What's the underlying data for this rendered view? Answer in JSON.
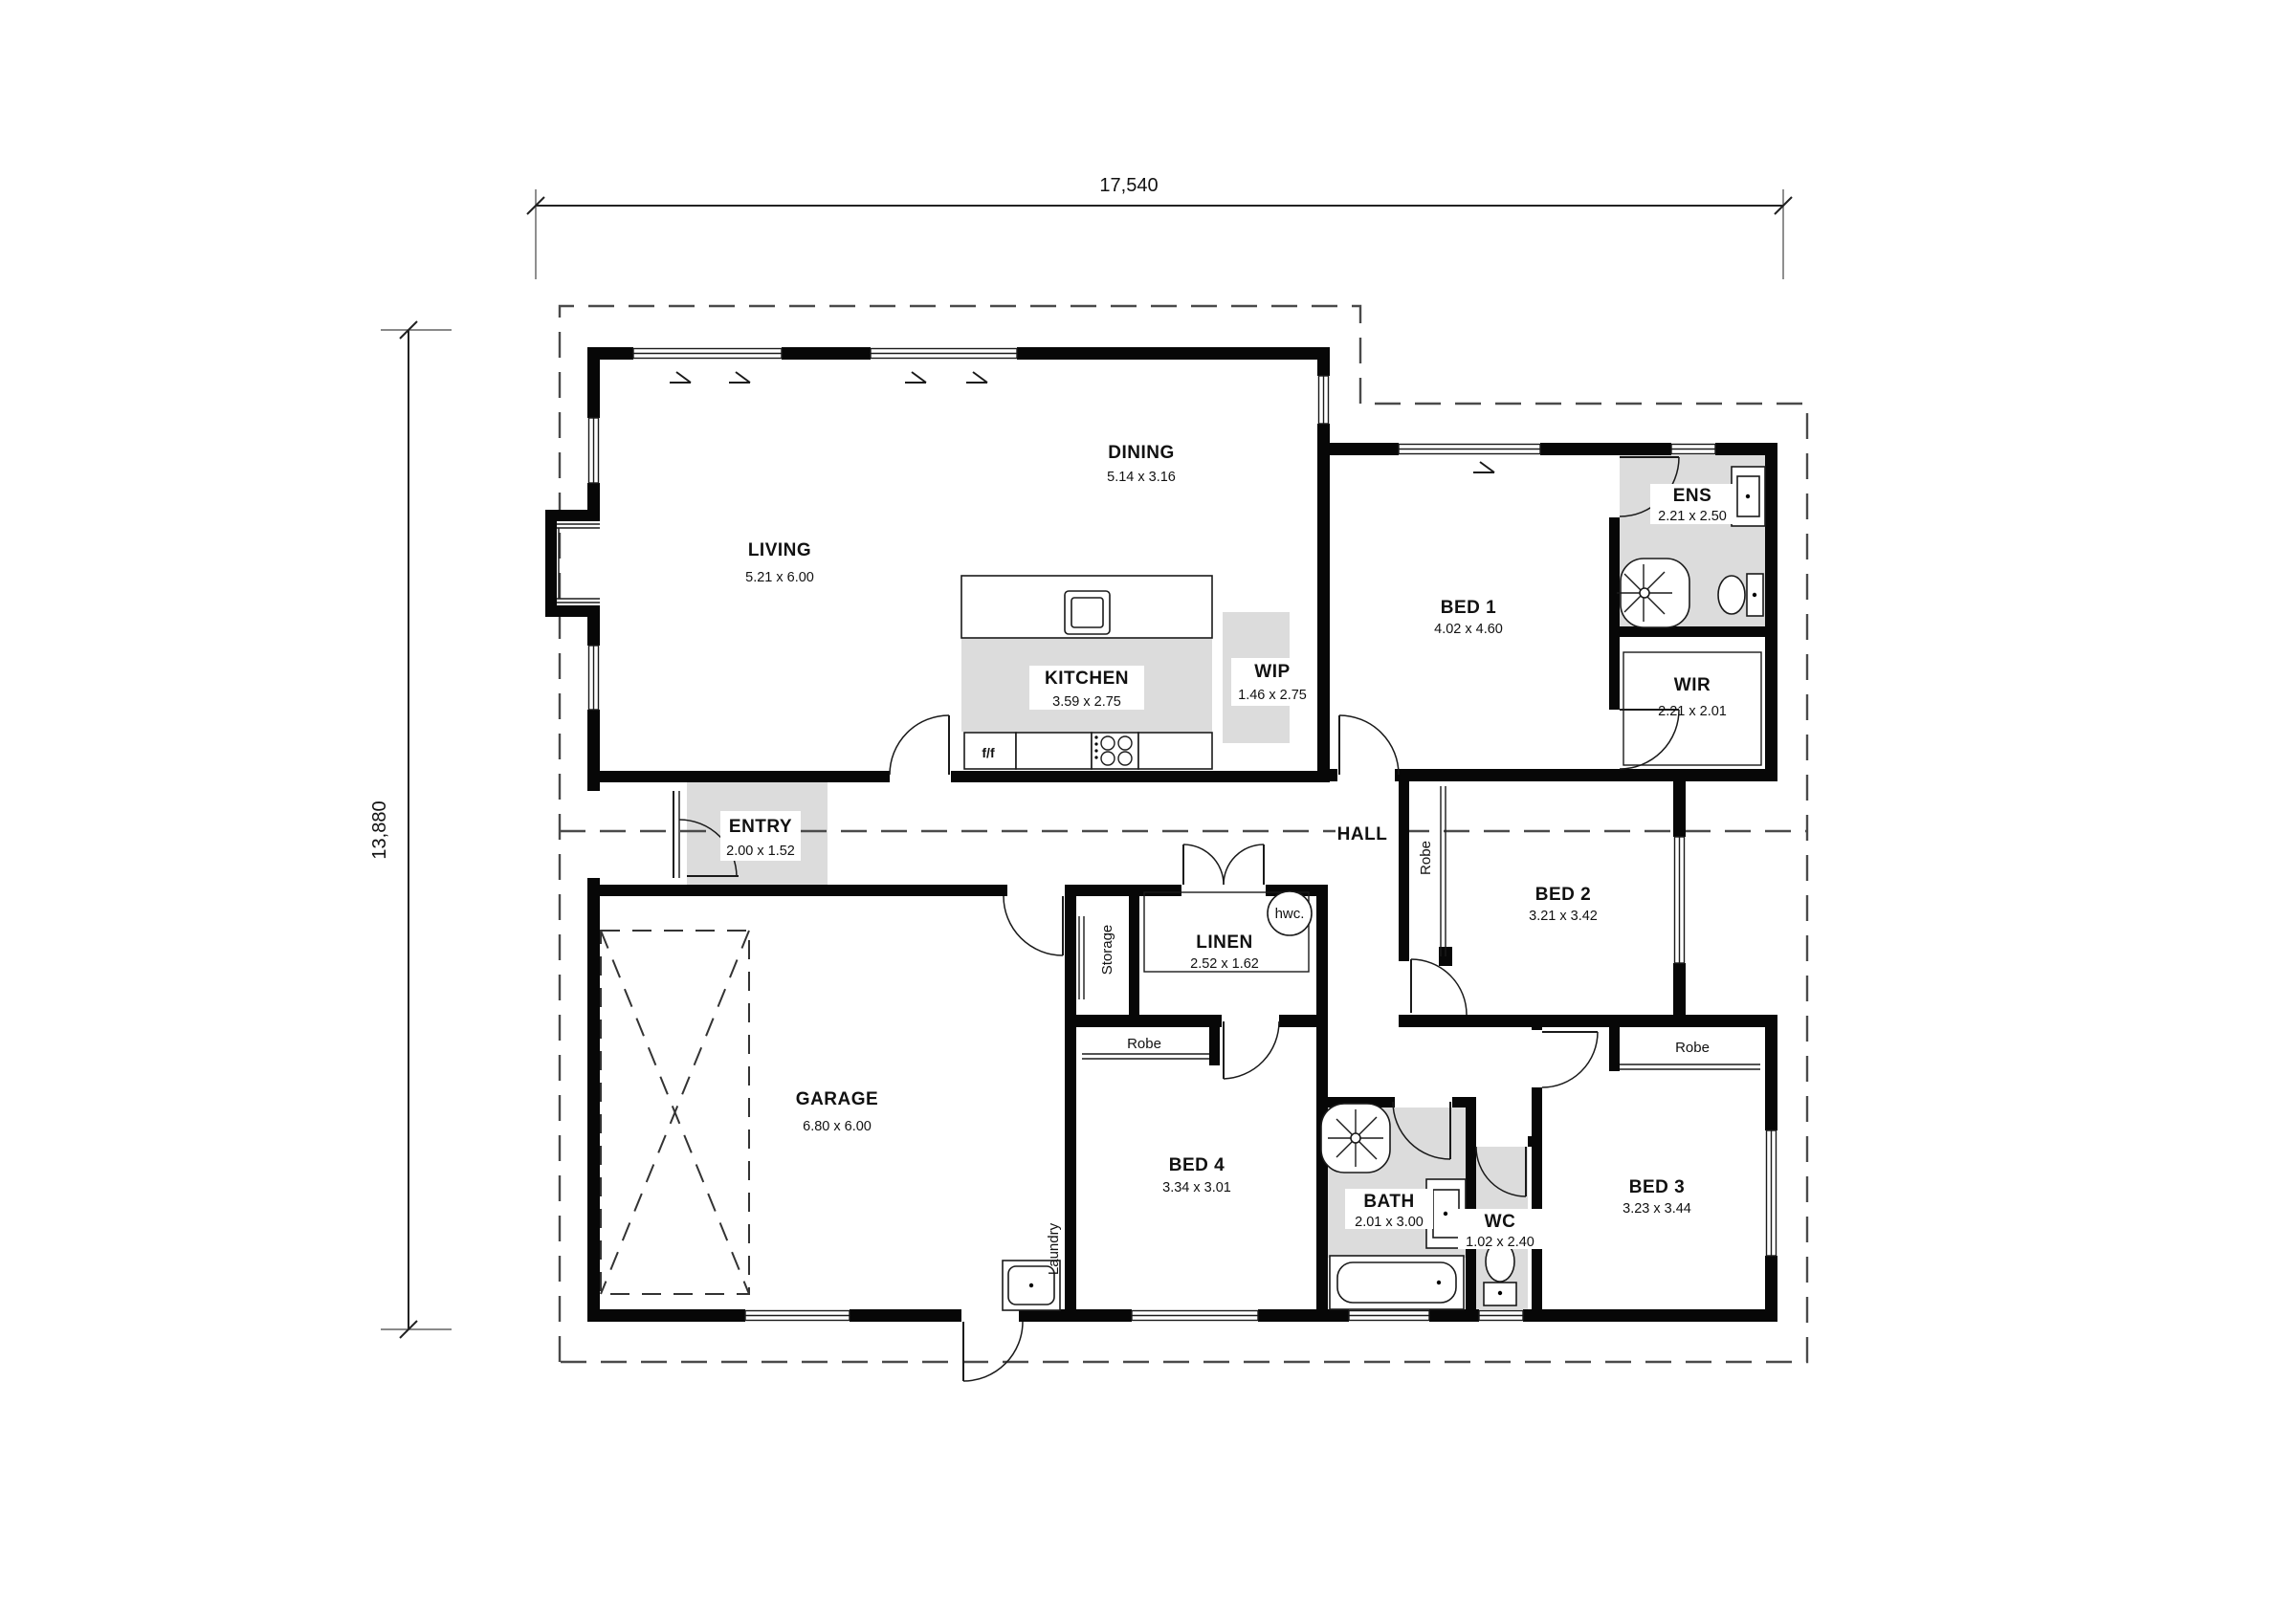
{
  "plan": {
    "dimensions": {
      "overall_width": "17,540",
      "overall_height": "13,880"
    },
    "rooms": {
      "living": {
        "name": "LIVING",
        "dims": "5.21 x 6.00"
      },
      "dining": {
        "name": "DINING",
        "dims": "5.14 x 3.16"
      },
      "kitchen": {
        "name": "KITCHEN",
        "dims": "3.59 x 2.75"
      },
      "wip": {
        "name": "WIP",
        "dims": "1.46 x 2.75"
      },
      "bed1": {
        "name": "BED 1",
        "dims": "4.02 x 4.60"
      },
      "ens": {
        "name": "ENS",
        "dims": "2.21 x 2.50"
      },
      "wir": {
        "name": "WIR",
        "dims": "2.21 x 2.01"
      },
      "entry": {
        "name": "ENTRY",
        "dims": "2.00 x 1.52"
      },
      "hall": {
        "name": "HALL"
      },
      "linen": {
        "name": "LINEN",
        "dims": "2.52 x 1.62"
      },
      "bed2": {
        "name": "BED 2",
        "dims": "3.21 x 3.42"
      },
      "garage": {
        "name": "GARAGE",
        "dims": "6.80 x 6.00"
      },
      "bed4": {
        "name": "BED 4",
        "dims": "3.34 x 3.01"
      },
      "bath": {
        "name": "BATH",
        "dims": "2.01 x 3.00"
      },
      "wc": {
        "name": "WC",
        "dims": "1.02 x 2.40"
      },
      "bed3": {
        "name": "BED 3",
        "dims": "3.23 x 3.44"
      }
    },
    "labels": {
      "storage": "Storage",
      "laundry": "Laundry",
      "robe_bed2": "Robe",
      "robe_bed4": "Robe",
      "robe_bed3": "Robe",
      "hwc": "hwc.",
      "fridge": "f/f"
    }
  }
}
